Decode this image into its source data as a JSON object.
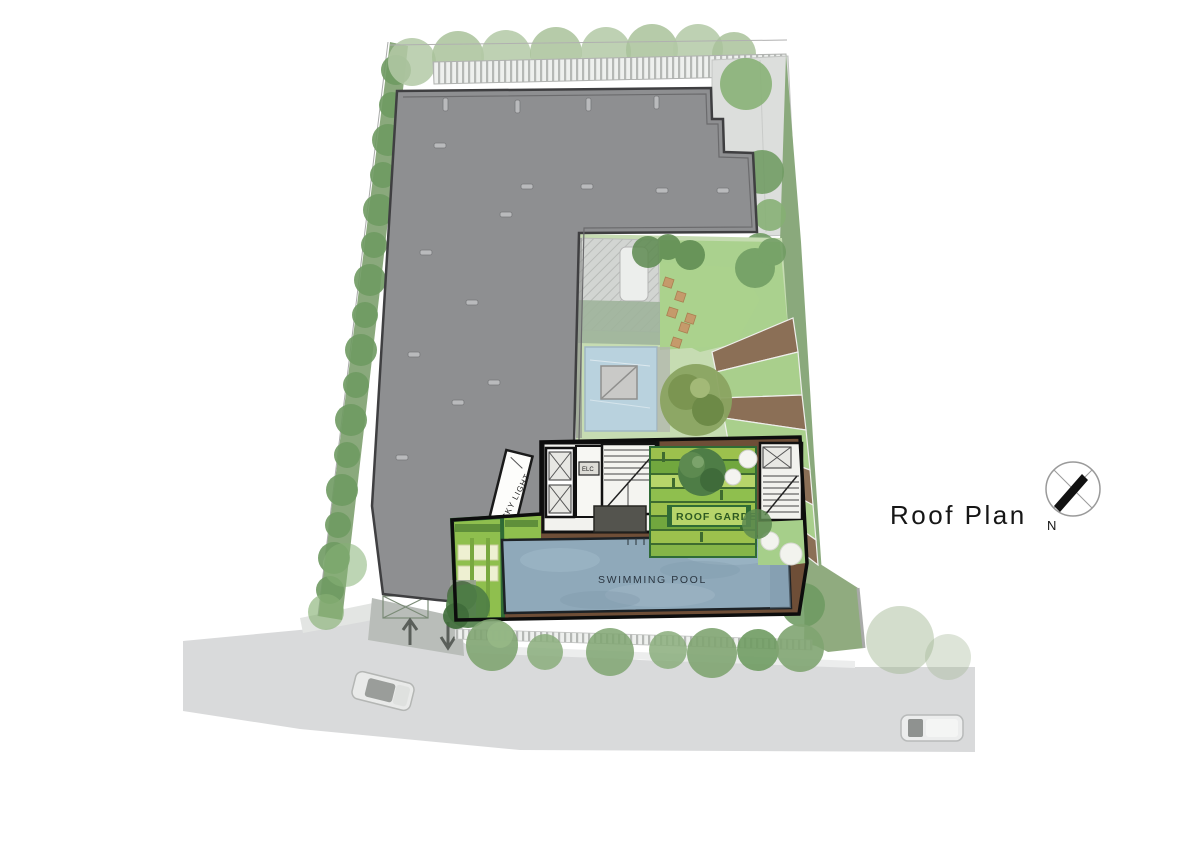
{
  "plan": {
    "title": "Roof Plan",
    "compass_label": "N",
    "labels": {
      "swimming_pool": "SWIMMING POOL",
      "roof_garden": "ROOF GARDEN",
      "sky_light": "SKY LIGHT",
      "elc": "ELC"
    },
    "colors": {
      "roof-gray": "#8e8f91",
      "road-gray": "#d9dadb",
      "deck-wood": "#6e4e37",
      "pool-water": "#8fa9ba",
      "lawn-light": "#c6dcb2",
      "lawn-bright": "#a6cf8a",
      "planting-green": "#8fbf4e",
      "tree-green": "#6f9b62",
      "border-green": "#2f6b35",
      "path-brown": "#8b6f56",
      "ink": "#161616"
    }
  }
}
